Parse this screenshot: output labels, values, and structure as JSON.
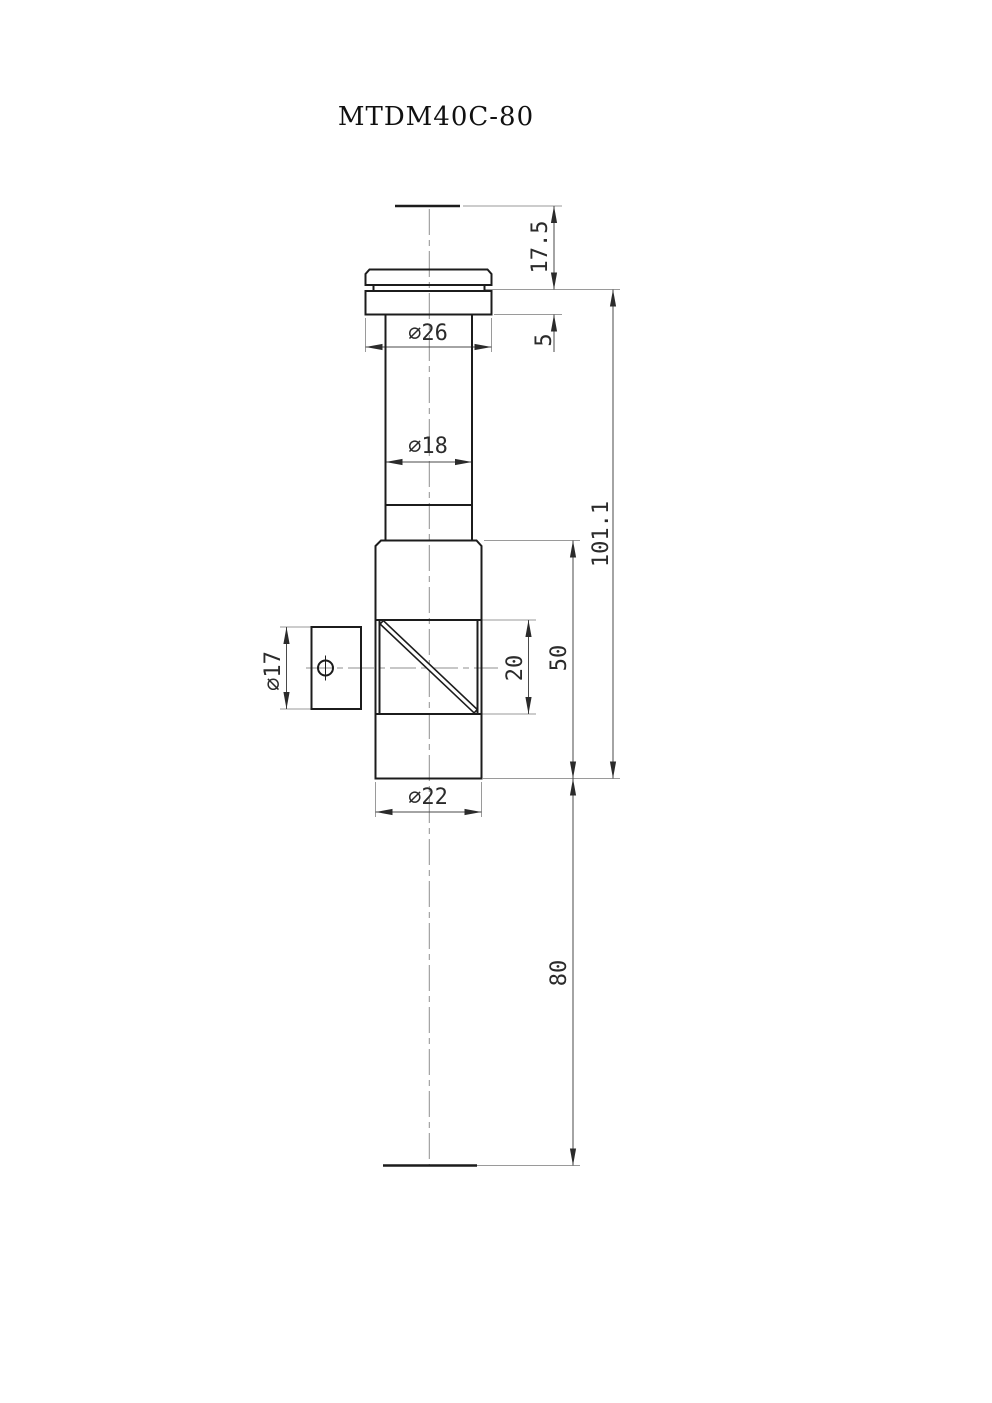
{
  "title": "MTDM40C-80",
  "dims": {
    "d17_5": "17.5",
    "d5": "5",
    "d101_1": "101.1",
    "d26": "∅26",
    "d18": "∅18",
    "d17": "∅17",
    "d20": "20",
    "d50": "50",
    "d22": "∅22",
    "d80": "80"
  }
}
